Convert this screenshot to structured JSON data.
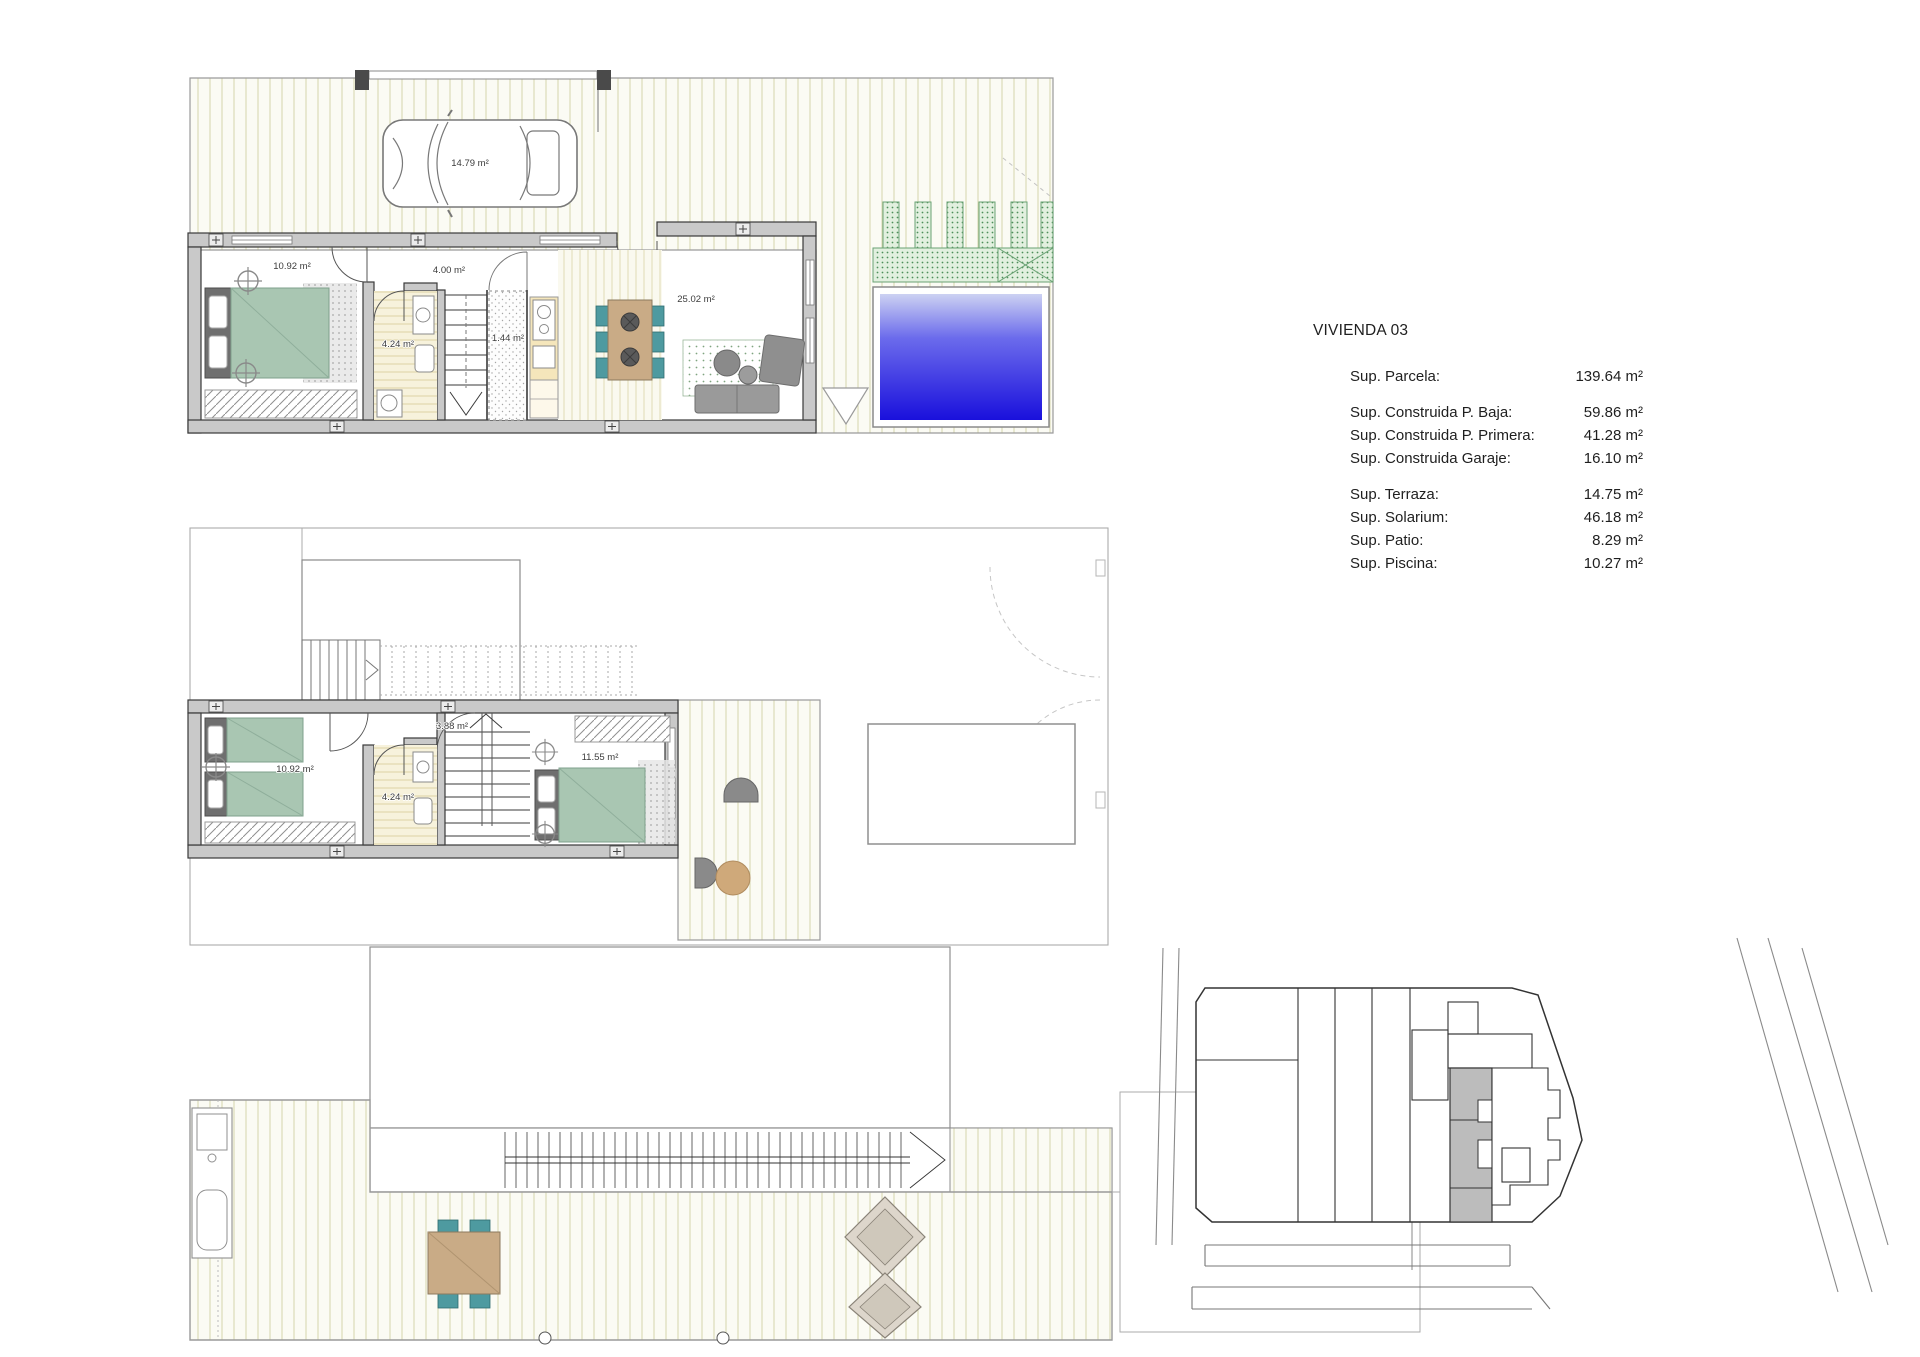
{
  "info_panel": {
    "title": "VIVIENDA 03",
    "rows": [
      {
        "label": "Sup. Parcela:",
        "value": "139.64 m²"
      },
      {
        "label": "Sup. Construida P. Baja:",
        "value": "59.86 m²"
      },
      {
        "label": "Sup. Construida P. Primera:",
        "value": "41.28 m²"
      },
      {
        "label": "Sup. Construida Garaje:",
        "value": "16.10 m²"
      },
      {
        "label": "Sup. Terraza:",
        "value": "14.75 m²"
      },
      {
        "label": "Sup. Solarium:",
        "value": "46.18 m²"
      },
      {
        "label": "Sup. Patio:",
        "value": "8.29 m²"
      },
      {
        "label": "Sup. Piscina:",
        "value": "10.27 m²"
      }
    ]
  },
  "plans": {
    "ground": {
      "labels": {
        "parking": "14.79 m²",
        "bedroom": "10.92 m²",
        "hall": "4.00 m²",
        "bath": "4.24 m²",
        "wc": "1.44 m²",
        "living": "25.02 m²"
      }
    },
    "first": {
      "labels": {
        "bedroom": "10.92 m²",
        "hall": "3.88 m²",
        "bath": "4.24 m²",
        "master": "11.55 m²"
      }
    }
  },
  "colors": {
    "wall": "#c9c9c9",
    "wall_edge": "#3a3a3a",
    "bed": "#a9c6b2",
    "chair": "#4e9aa0",
    "table_wood": "#c9ab86",
    "pool_deep": "#1a10dc",
    "planter": "#4e8f5a",
    "site_highlight": "#bcbcbc"
  }
}
